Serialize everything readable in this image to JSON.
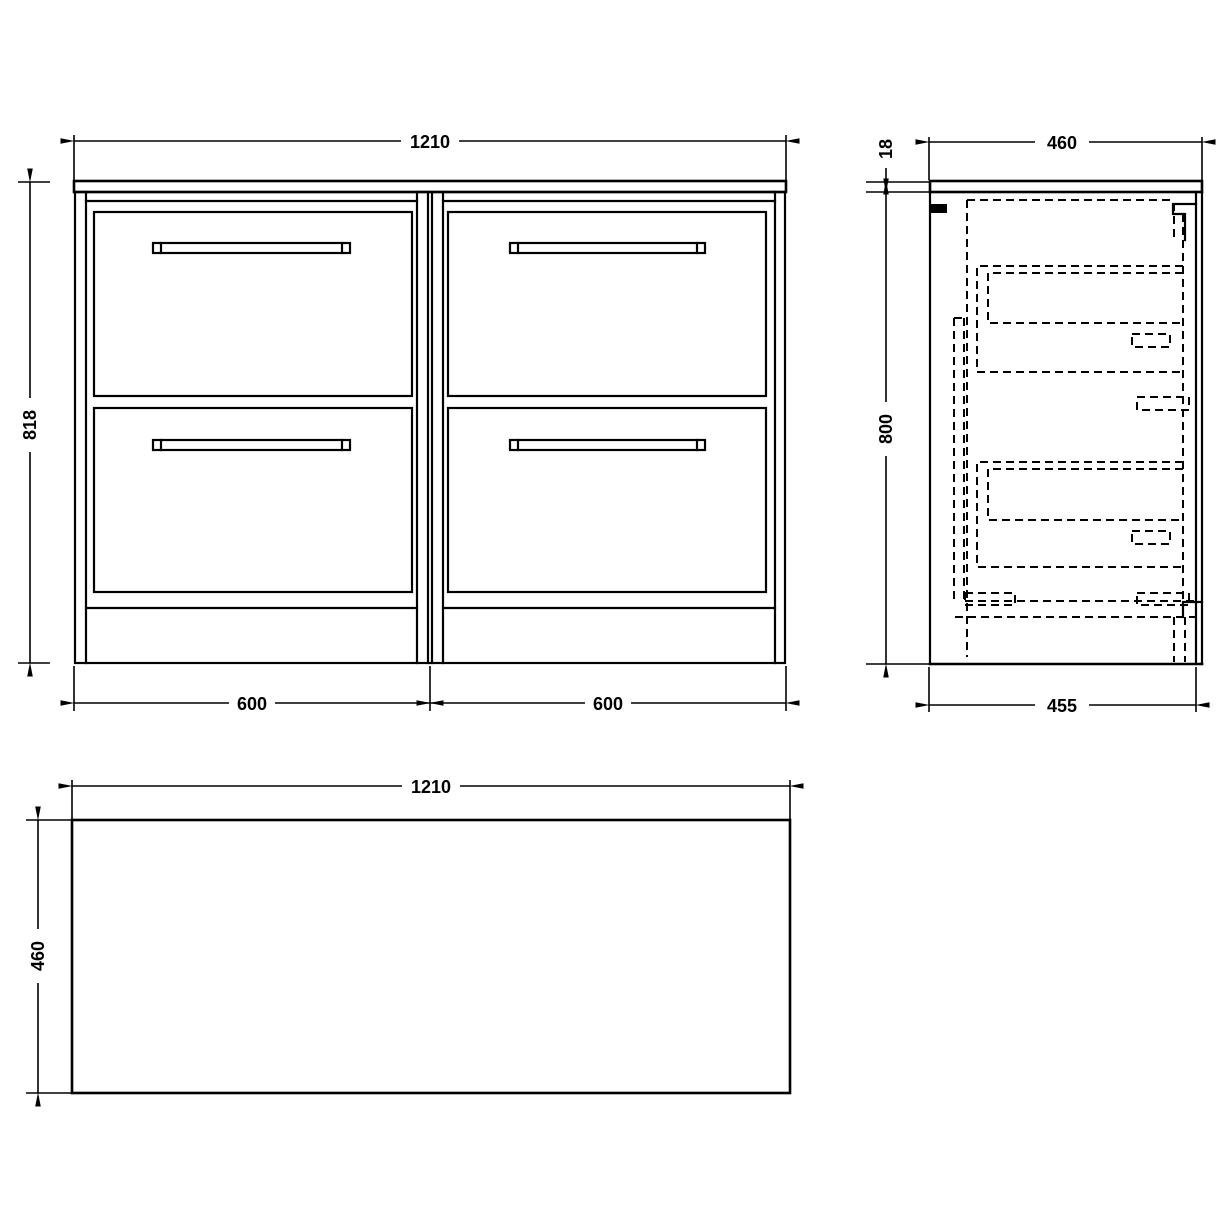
{
  "colors": {
    "line": "#000000",
    "background": "#ffffff"
  },
  "views": {
    "front": {
      "overall_width": "1210",
      "overall_height": "818",
      "left_unit_width": "600",
      "right_unit_width": "600"
    },
    "side": {
      "worktop_depth": "460",
      "worktop_thickness": "18",
      "unit_height": "800",
      "carcass_depth": "455"
    },
    "plan": {
      "width": "1210",
      "depth": "460"
    }
  }
}
